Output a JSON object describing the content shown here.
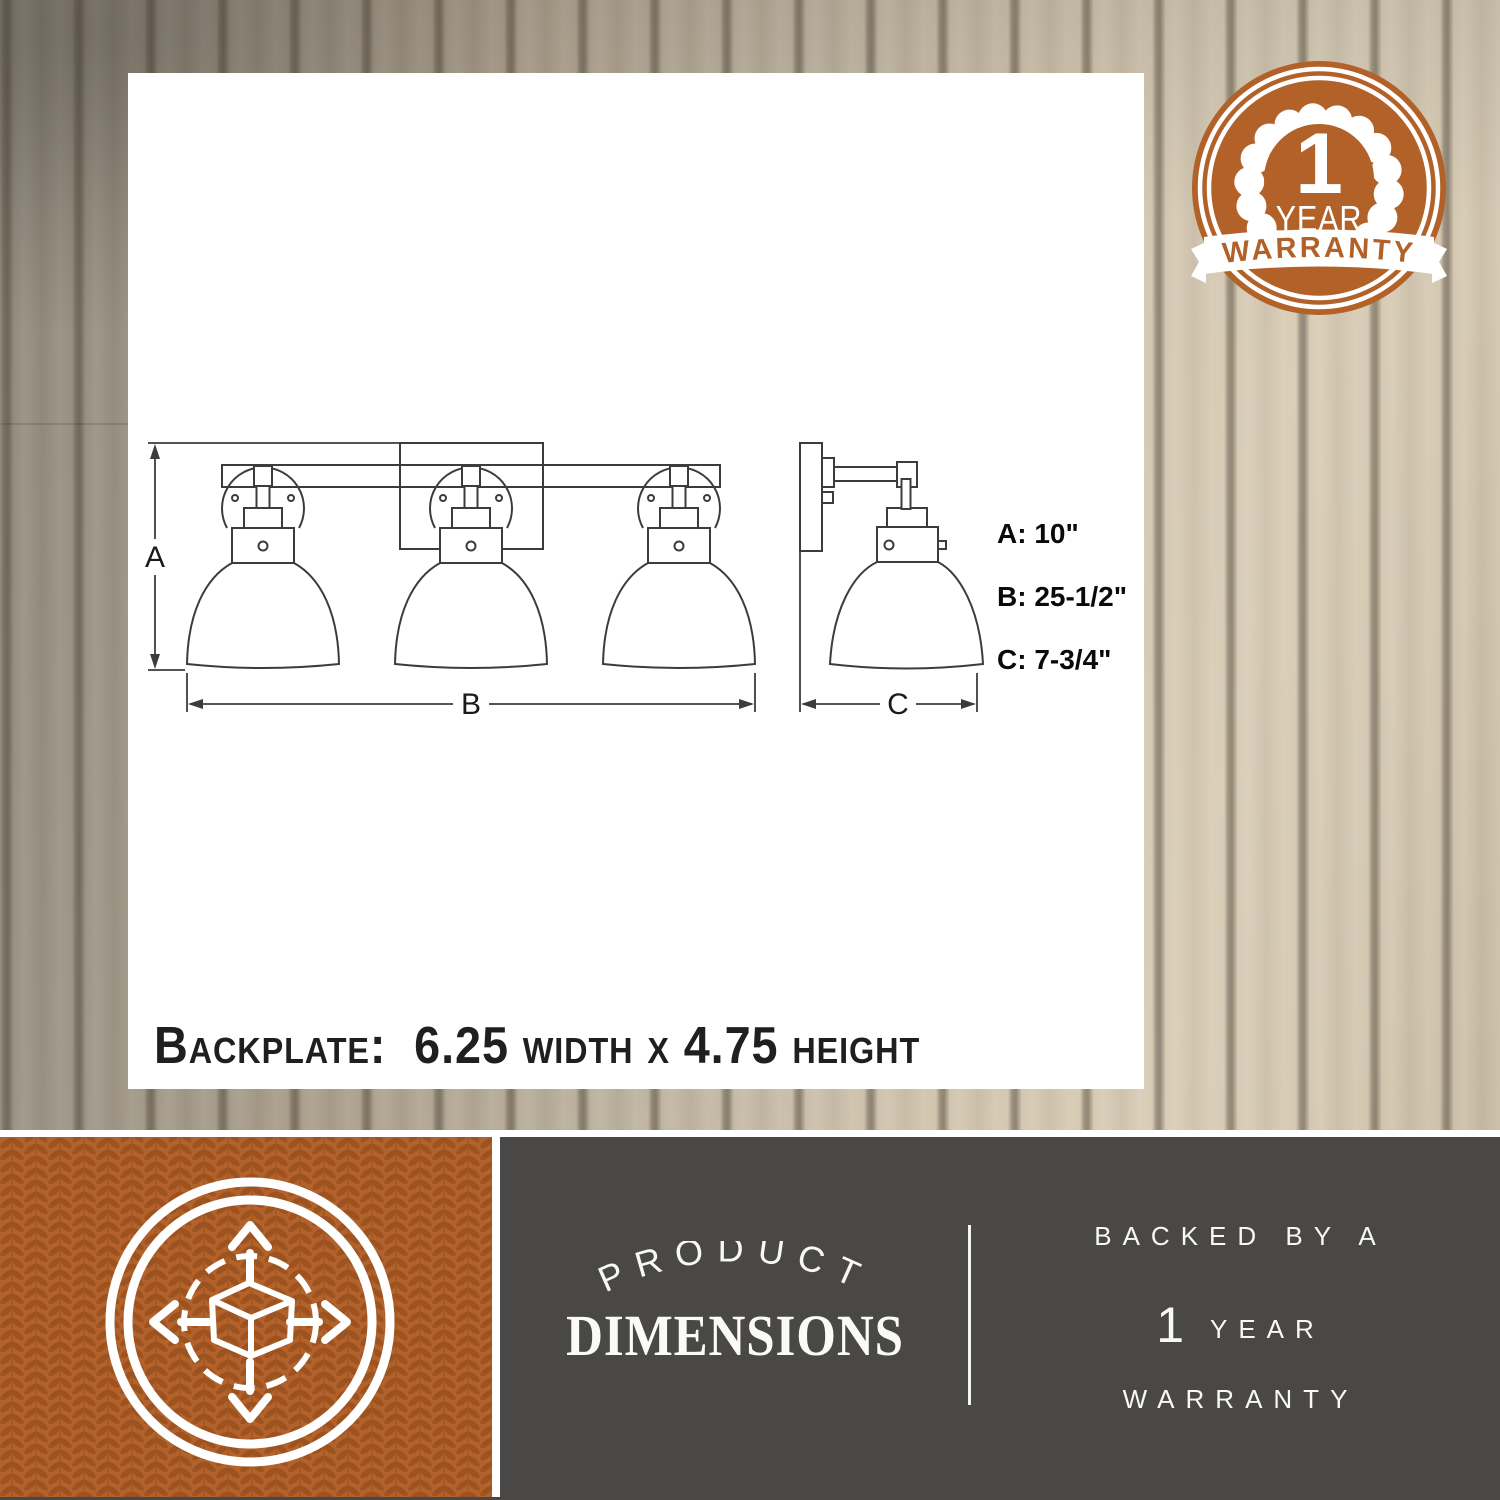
{
  "badge": {
    "number": "1",
    "year": "YEAR",
    "banner": "WARRANTY"
  },
  "diagram": {
    "label_a": "A",
    "label_b": "B",
    "label_c": "C",
    "dims": [
      {
        "text": "A: 10\""
      },
      {
        "text": "B: 25-1/2\""
      },
      {
        "text": "C: 7-3/4\""
      }
    ],
    "backplate_note": "Backplate:  6.25 width x 4.75 height"
  },
  "footer": {
    "arc_word": "PRODUCT",
    "main_word": "DIMENSIONS",
    "line1": "BACKED BY A",
    "number": "1",
    "year": "YEAR",
    "line3": "WARRANTY"
  },
  "colors": {
    "accent_orange": "#b26129",
    "panel_gray": "#4a4846"
  }
}
